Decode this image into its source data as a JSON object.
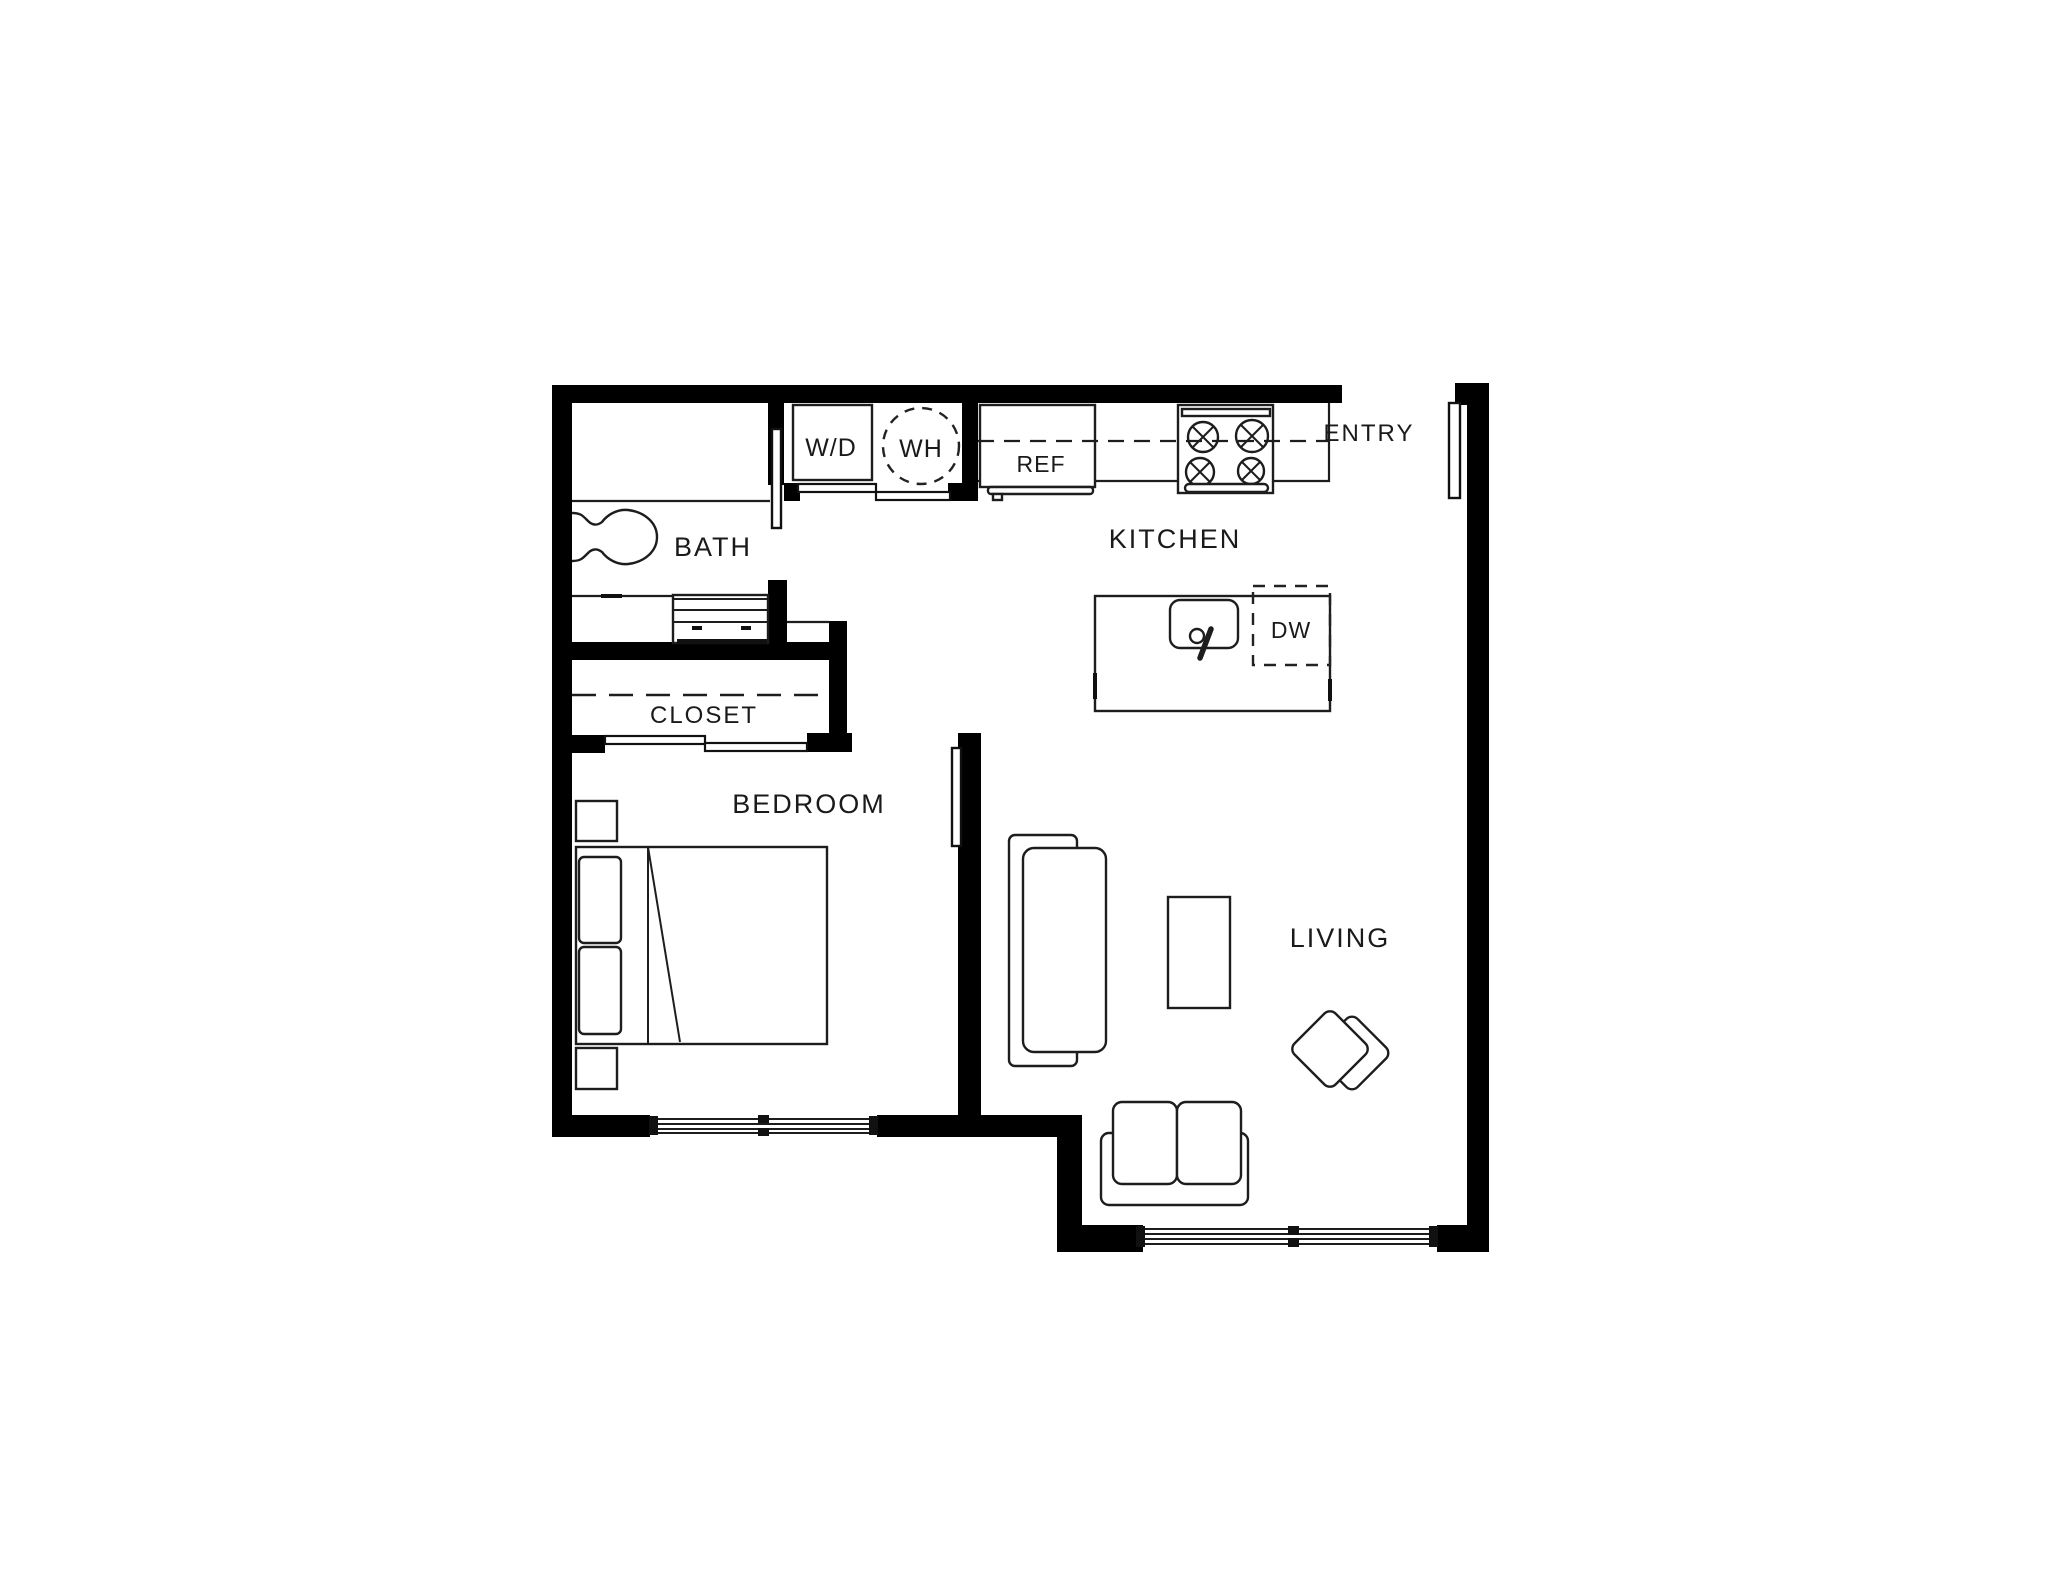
{
  "page": {
    "background": "#ffffff"
  },
  "palette": {
    "wall": "#000000",
    "line": "#1d1d1d",
    "text": "#1a1a1a"
  },
  "floor_plan": {
    "rooms": {
      "bath": {
        "label": "BATH"
      },
      "closet": {
        "label": "CLOSET"
      },
      "bedroom": {
        "label": "BEDROOM"
      },
      "kitchen": {
        "label": "KITCHEN"
      },
      "living": {
        "label": "LIVING"
      },
      "entry": {
        "label": "ENTRY"
      }
    },
    "appliances": {
      "washer_dryer": {
        "label": "W/D"
      },
      "water_heater": {
        "label": "WH"
      },
      "refrigerator": {
        "label": "REF"
      },
      "dishwasher": {
        "label": "DW"
      }
    }
  }
}
